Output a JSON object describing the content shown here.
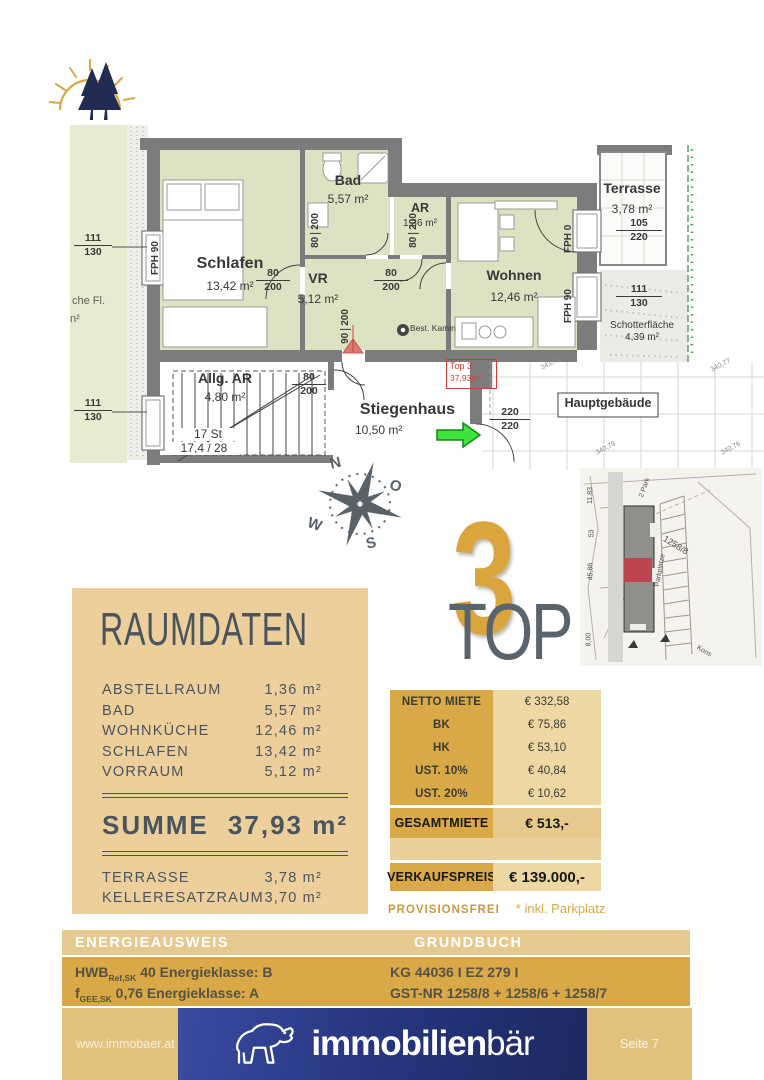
{
  "floorplan": {
    "garden_text": {
      "line1": "che Fl.",
      "line2": "n²"
    },
    "rooms": {
      "schlafen": {
        "name": "Schlafen",
        "area": "13,42 m²"
      },
      "bad": {
        "name": "Bad",
        "area": "5,57 m²"
      },
      "ar": {
        "name": "AR",
        "area": "1,36 m²"
      },
      "vr": {
        "name": "VR",
        "area": "5,12 m²"
      },
      "wohnen": {
        "name": "Wohnen",
        "area": "12,46 m²"
      },
      "terrasse": {
        "name": "Terrasse",
        "area": "3,78 m²"
      },
      "allg_ar": {
        "name": "Allg. AR",
        "area": "4,80 m²"
      },
      "stiegenhaus": {
        "name": "Stiegenhaus",
        "area": "10,50 m²"
      },
      "schotterflaeche": {
        "name": "Schotterfläche",
        "area": "4,39 m²"
      }
    },
    "dims": {
      "window_left_top": {
        "a": "111",
        "b": "130"
      },
      "window_left_bottom": {
        "a": "111",
        "b": "130"
      },
      "window_right": {
        "a": "111",
        "b": "130"
      },
      "terrasse_door": {
        "a": "105",
        "b": "220"
      },
      "haupt_door": {
        "a": "220",
        "b": "220"
      },
      "door_schlafen": {
        "a": "80",
        "b": "200"
      },
      "door_bad": {
        "a": "80",
        "b": "200"
      },
      "door_ar": {
        "a": "80",
        "b": "200"
      },
      "door_wohnen": {
        "a": "80",
        "b": "200"
      },
      "door_vr": {
        "a": "90",
        "b": "200"
      },
      "door_allg_ar": {
        "a": "80",
        "b": "200"
      }
    },
    "fph": {
      "left": "FPH 90",
      "terrasse": "FPH 0",
      "right": "FPH 90"
    },
    "stairs": {
      "line1": "17 St",
      "line2": "17,4 / 28"
    },
    "kamin_label": "Best. Kamin",
    "top3_box": {
      "line1": "Top 3",
      "line2": "37,93m²"
    },
    "hauptgebaeude_label": "Hauptgebäude",
    "elevations": [
      "343,76",
      "340,77",
      "340,79",
      "340,76"
    ],
    "compass": {
      "n": "N",
      "o": "O",
      "s": "S",
      "w": "W"
    }
  },
  "siteplan": {
    "labels": [
      "11,83",
      "53",
      "45,86",
      "8,00",
      "1258/8",
      "Parkplätze",
      "2 Park",
      "Kons"
    ]
  },
  "badge": {
    "word": "TOP",
    "number": "3"
  },
  "raumdaten": {
    "title": "RAUMDATEN",
    "rows": [
      {
        "label": "ABSTELLRAUM",
        "value": "1,36 m²"
      },
      {
        "label": "BAD",
        "value": "5,57 m²"
      },
      {
        "label": "WOHNKÜCHE",
        "value": "12,46 m²"
      },
      {
        "label": "SCHLAFEN",
        "value": "13,42 m²"
      },
      {
        "label": "VORRAUM",
        "value": "5,12 m²"
      }
    ],
    "summe": {
      "label": "SUMME",
      "value": "37,93 m²"
    },
    "extra_rows": [
      {
        "label": "TERRASSE",
        "value": "3,78 m²"
      },
      {
        "label": "KELLERESATZRAUM",
        "value": "3,70 m²"
      }
    ]
  },
  "price_table": {
    "rows": [
      {
        "label": "NETTO MIETE",
        "value": "€ 332,58"
      },
      {
        "label": "BK",
        "value": "€ 75,86"
      },
      {
        "label": "HK",
        "value": "€ 53,10"
      },
      {
        "label": "UST. 10%",
        "value": "€ 40,84"
      },
      {
        "label": "UST. 20%",
        "value": "€ 10,62"
      }
    ],
    "gesamtmiete": {
      "label": "GESAMTMIETE",
      "value": "€ 513,-"
    },
    "verkaufspreis": {
      "label": "VERKAUFSPREIS",
      "value": "€ 139.000,-"
    },
    "provisionsfrei": "PROVISIONSFREI",
    "note": "* inkl. Parkplatz"
  },
  "energieausweis": {
    "title": "ENERGIEAUSWEIS",
    "row1": {
      "prefix": "HWB",
      "sub": "Ref,SK",
      "text": " 40 Energieklasse: B"
    },
    "row2": {
      "prefix": "f",
      "sub": "GEE,SK",
      "text": " 0,76 Energieklasse: A"
    }
  },
  "grundbuch": {
    "title": "GRUNDBUCH",
    "row1": "KG 44036  I EZ 279 I",
    "row2": "GST-NR 1258/8 + 1258/6 + 1258/7"
  },
  "footer": {
    "website": "www.immobaer.at",
    "brand_bold": "immobilien",
    "brand_light": "bär",
    "page": "Seite 7"
  },
  "colors": {
    "gold": "#D9A847",
    "gold_light": "#ECCF9A",
    "gold_header": "#E6C98F",
    "gold_footer": "#E2C17D",
    "navy": "#27357E",
    "slate_text": "#4A545E",
    "plan_green": "#DCE3C2",
    "garden_green": "#E8EBD2",
    "wall_grey": "#7C7C7C",
    "red_marker": "#D23B34",
    "arrow_green": "#3FE23F"
  }
}
